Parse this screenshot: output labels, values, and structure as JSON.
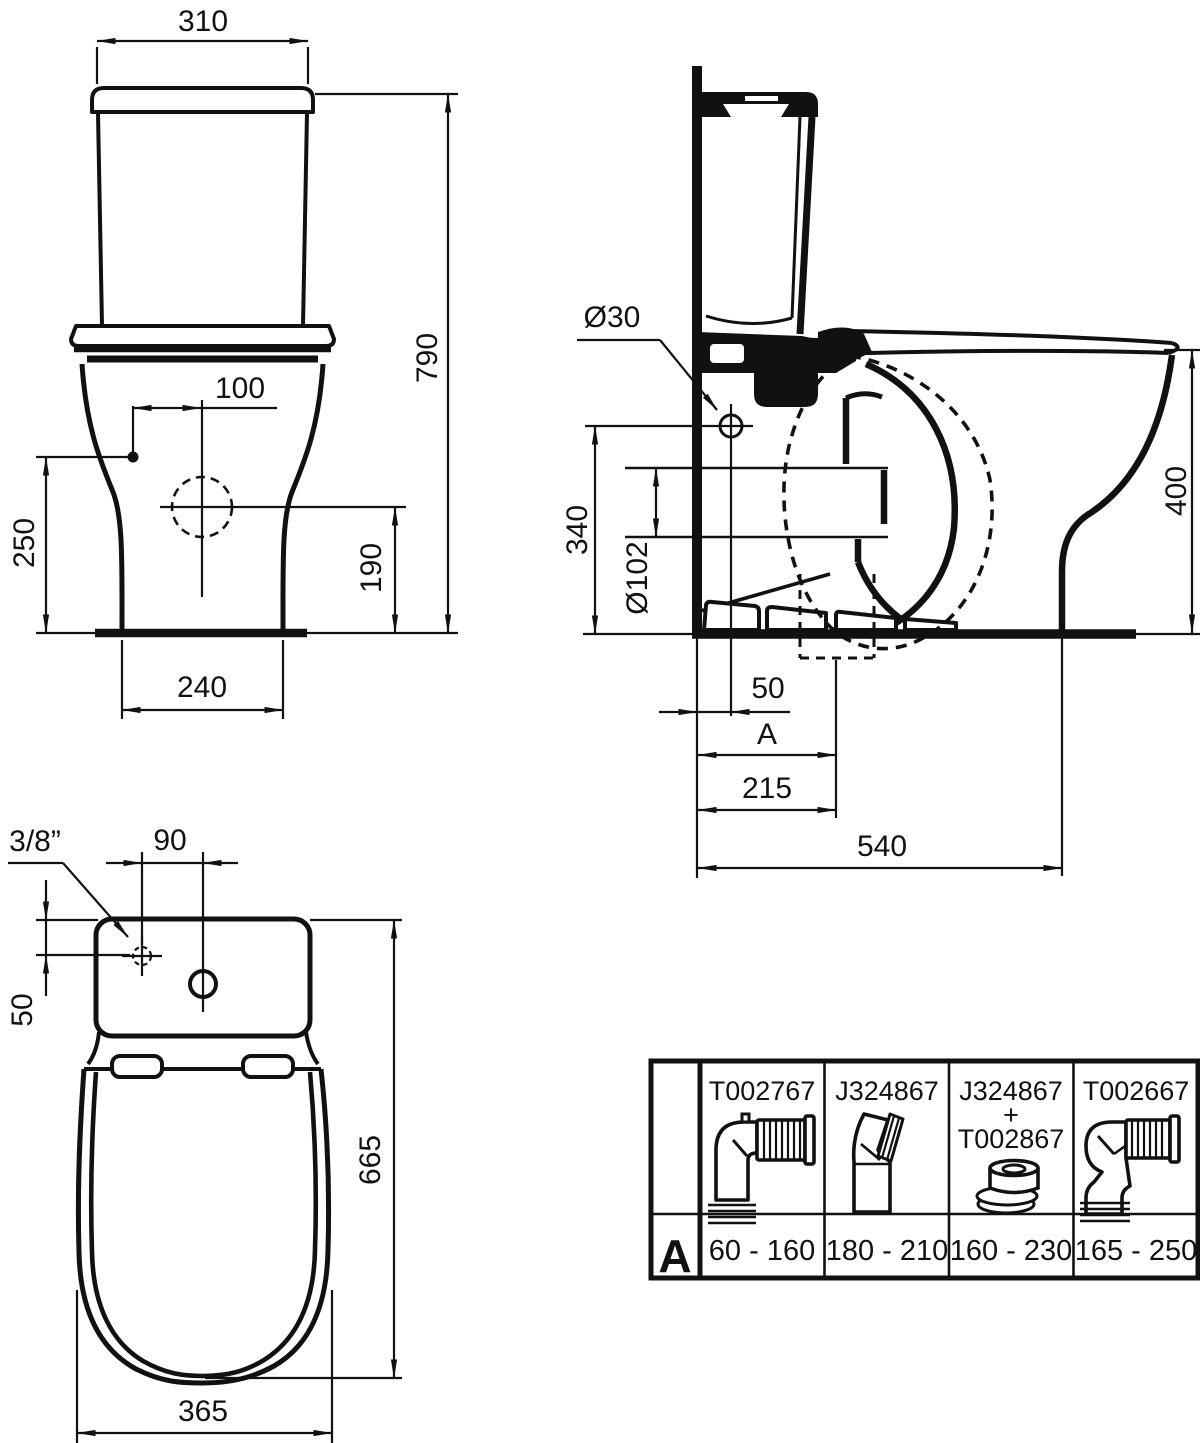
{
  "drawing": {
    "title": "WC close-coupled pan and cistern dimensional drawing",
    "front_view": {
      "dims": {
        "tank_width": "310",
        "total_height": "790",
        "supply_hole_offset": "100",
        "supply_hole_height": "250",
        "outlet_height": "190",
        "base_width": "240"
      }
    },
    "side_view": {
      "dims": {
        "supply_hole_diameter": "Ø30",
        "supply_hole_height": "340",
        "outlet_diameter": "Ø102",
        "bowl_height": "400",
        "supply_hole_setback": "50",
        "rough_in_label": "A",
        "outlet_setback": "215",
        "total_depth": "540"
      }
    },
    "top_view": {
      "dims": {
        "inlet_thread": "3/8”",
        "hole_spacing": "90",
        "hole_setback": "50",
        "total_depth": "665",
        "bowl_width": "365"
      }
    },
    "accessory_table": {
      "row_label": "A",
      "columns": [
        {
          "code_lines": [
            "T002767"
          ],
          "range": "60 - 160",
          "icon": "pan-connector-90-icon"
        },
        {
          "code_lines": [
            "J324867"
          ],
          "range": "180 - 210",
          "icon": "offset-connector-icon"
        },
        {
          "code_lines": [
            "J324867",
            "+",
            "T002867"
          ],
          "range": "160 - 230",
          "icon": "eccentric-ring-icon"
        },
        {
          "code_lines": [
            "T002667"
          ],
          "range": "165 - 250",
          "icon": "swan-neck-connector-icon"
        }
      ]
    }
  }
}
